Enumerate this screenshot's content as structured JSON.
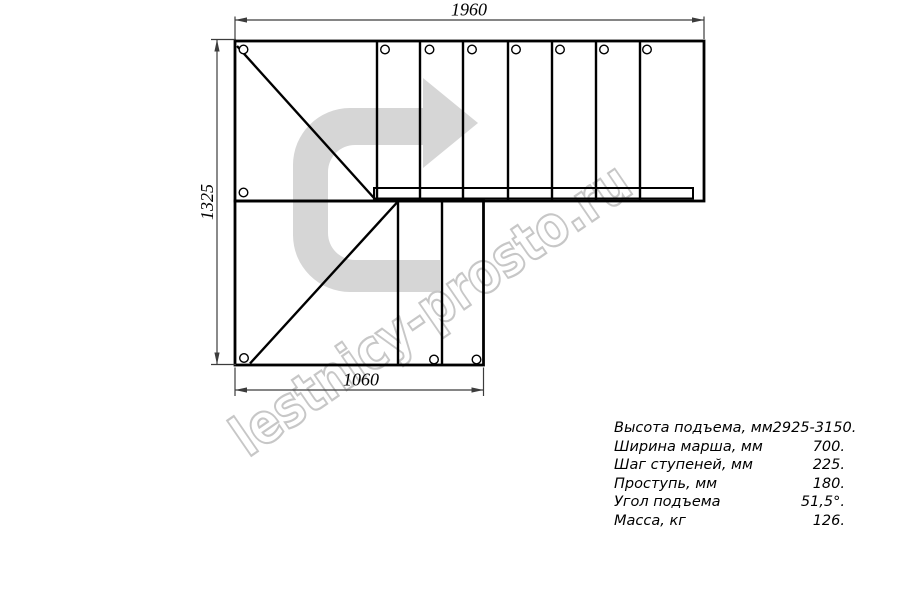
{
  "watermark": {
    "text": "lestnicy-prosto.ru",
    "color": "#c7c7c7"
  },
  "direction_arrow": {
    "meaning": "stair-walk-direction",
    "fill": "#d6d6d6"
  },
  "dimensions": {
    "top": {
      "value": "1960",
      "unit": "mm"
    },
    "left": {
      "value": "1325",
      "unit": "mm"
    },
    "bottom": {
      "value": "1060",
      "unit": "mm"
    }
  },
  "specs": {
    "rows": [
      {
        "label": "Высота подъема, мм",
        "value": "2925-3150."
      },
      {
        "label": "Ширина марша, мм",
        "value": "700."
      },
      {
        "label": "Шаг ступеней, мм",
        "value": "225."
      },
      {
        "label": "Проступь, мм",
        "value": "180."
      },
      {
        "label": "Угол подъема",
        "value": "51,5°."
      },
      {
        "label": "Масса, кг",
        "value": "126."
      }
    ]
  },
  "colors": {
    "line": "#000000",
    "dimension": "#3c3c3c",
    "arrow_fill": "#d6d6d6",
    "watermark": "#c7c7c7",
    "background": "#ffffff"
  }
}
